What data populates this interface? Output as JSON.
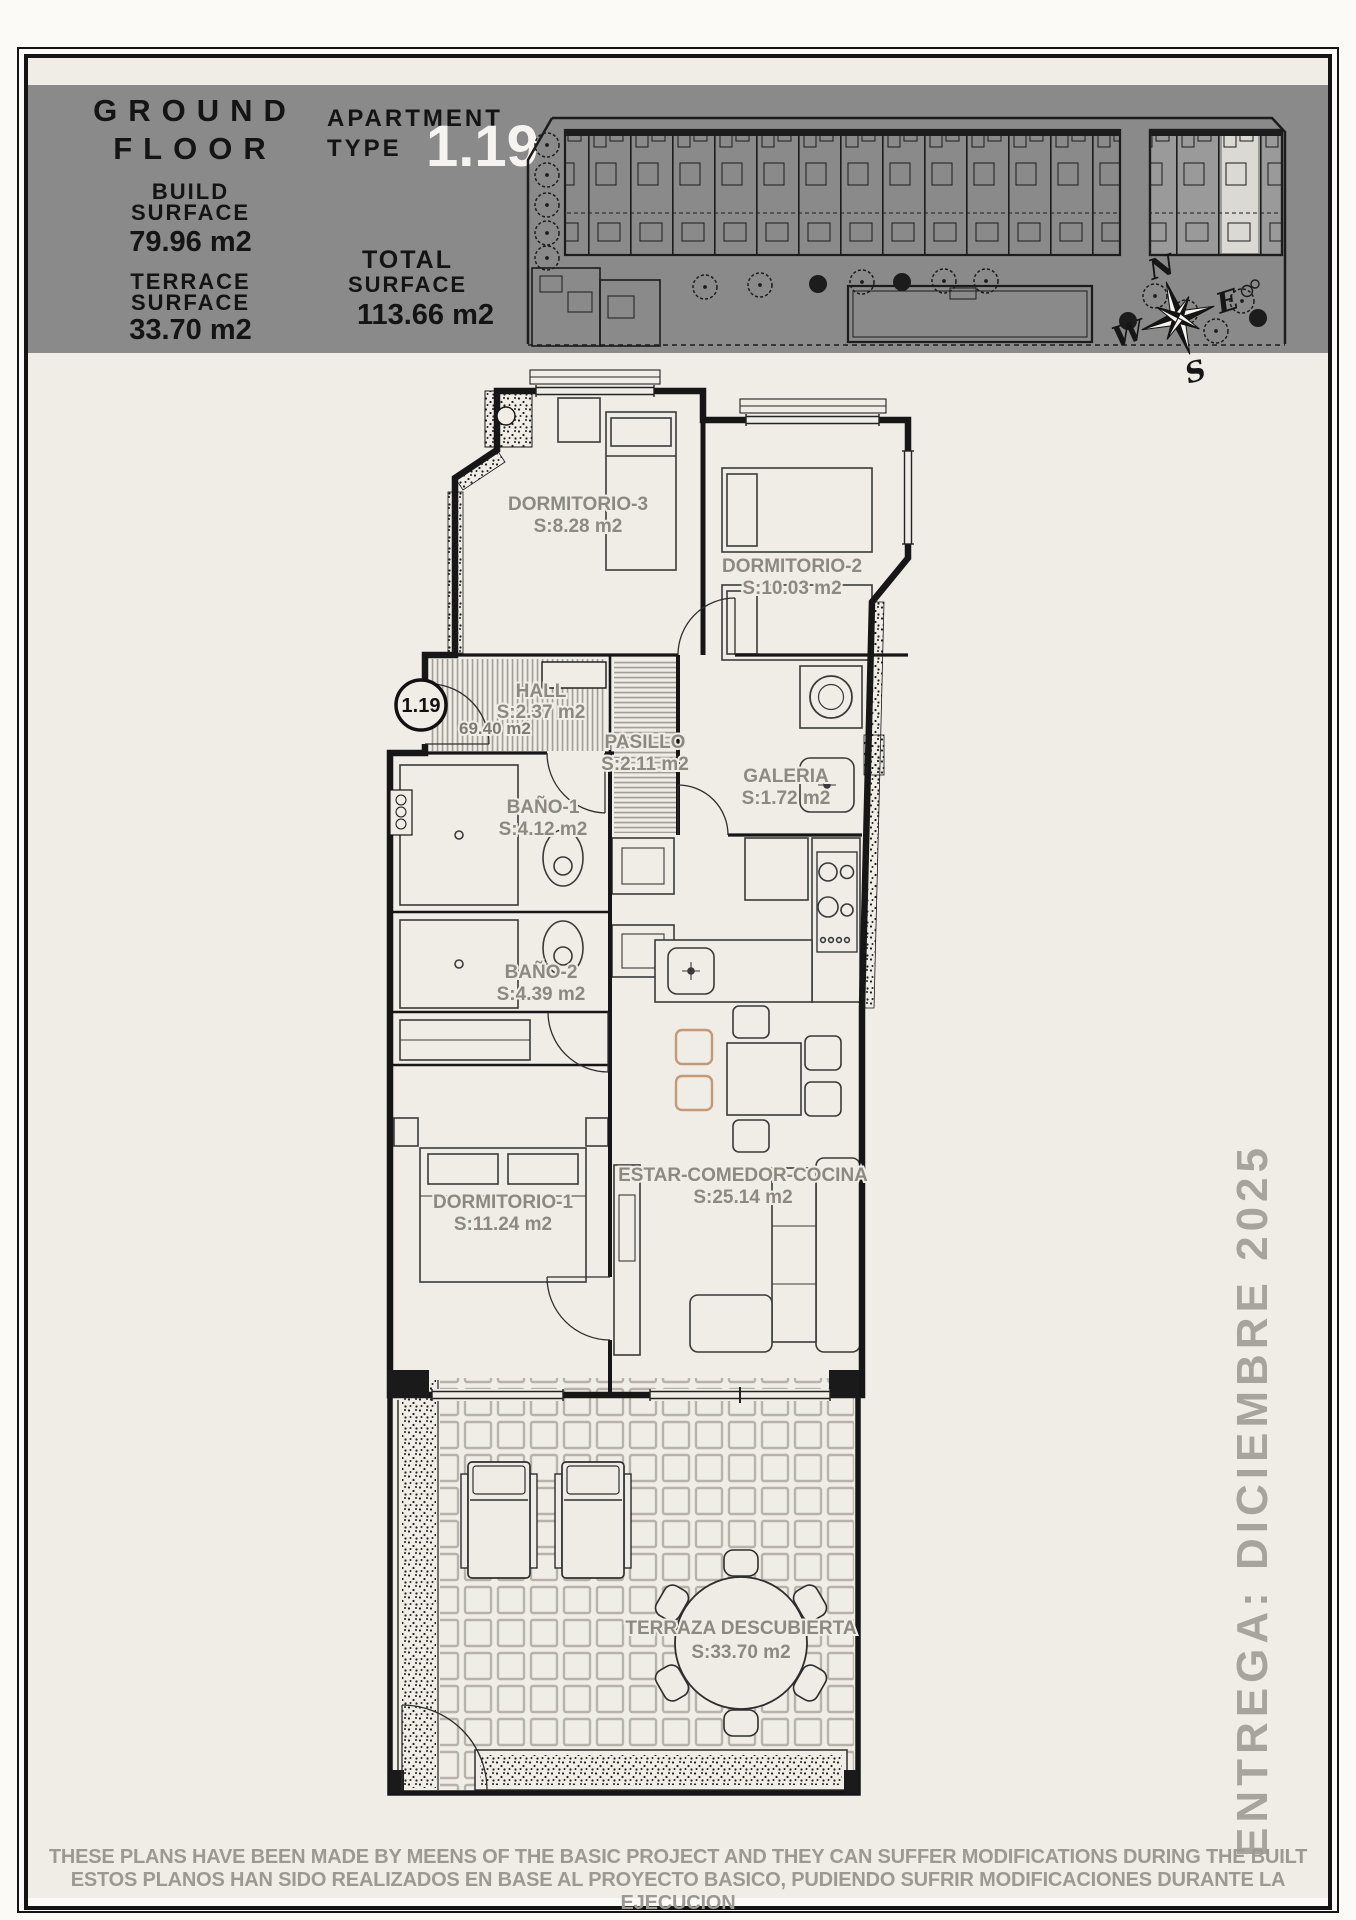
{
  "header": {
    "floor_title_line1": "GROUND",
    "floor_title_line2": "FLOOR",
    "build_label_1": "BUILD",
    "build_label_2": "SURFACE",
    "build_value": "79.96 m2",
    "terrace_label_1": "TERRACE",
    "terrace_label_2": "SURFACE",
    "terrace_value": "33.70 m2",
    "apartment_label_1": "APARTMENT",
    "apartment_label_2": "TYPE",
    "apartment_number": "1.19",
    "total_label_1": "TOTAL",
    "total_label_2": "SURFACE",
    "total_value": "113.66 m2"
  },
  "compass": {
    "n": "N",
    "e": "E",
    "s": "S",
    "w": "W"
  },
  "unit_marker": {
    "number": "1.19",
    "area": "69.40 m2"
  },
  "rooms": [
    {
      "name": "DORMITORIO-3",
      "area": "S:8.28 m2"
    },
    {
      "name": "DORMITORIO-2",
      "area": "S:10.03 m2"
    },
    {
      "name": "HALL",
      "area": "S:2.37 m2"
    },
    {
      "name": "PASILLO",
      "area": "S:2.11 m2"
    },
    {
      "name": "GALERIA",
      "area": "S:1.72 m2"
    },
    {
      "name": "BAÑO-1",
      "area": "S:4.12 m2"
    },
    {
      "name": "BAÑO-2",
      "area": "S:4.39 m2"
    },
    {
      "name": "DORMITORIO-1",
      "area": "S:11.24 m2"
    },
    {
      "name": "ESTAR-COMEDOR-COCINA",
      "area": "S:25.14 m2"
    },
    {
      "name": "TERRAZA DESCUBIERTA",
      "area": "S:33.70 m2"
    }
  ],
  "delivery_note": "ENTREGA: DICIEMBRE 2025",
  "disclaimer": {
    "line1_en": "THESE PLANS HAVE BEEN MADE BY MEENS OF THE BASIC PROJECT AND THEY CAN SUFFER MODIFICATIONS DURING THE BUILT",
    "line2_es": "ESTOS PLANOS HAN SIDO REALIZADOS EN BASE AL PROYECTO BASICO, PUDIENDO SUFRIR MODIFICACIONES DURANTE LA EJECUCION"
  },
  "colors": {
    "header_band": "#8a8a8a",
    "page_background": "#f0ede6",
    "line_black": "#141414",
    "label_gray": "#8c8980",
    "accent_chair_tan": "#c49a76",
    "apartment_number_white": "#f5f4f0",
    "highlight_unit": "#dbd9d3"
  }
}
